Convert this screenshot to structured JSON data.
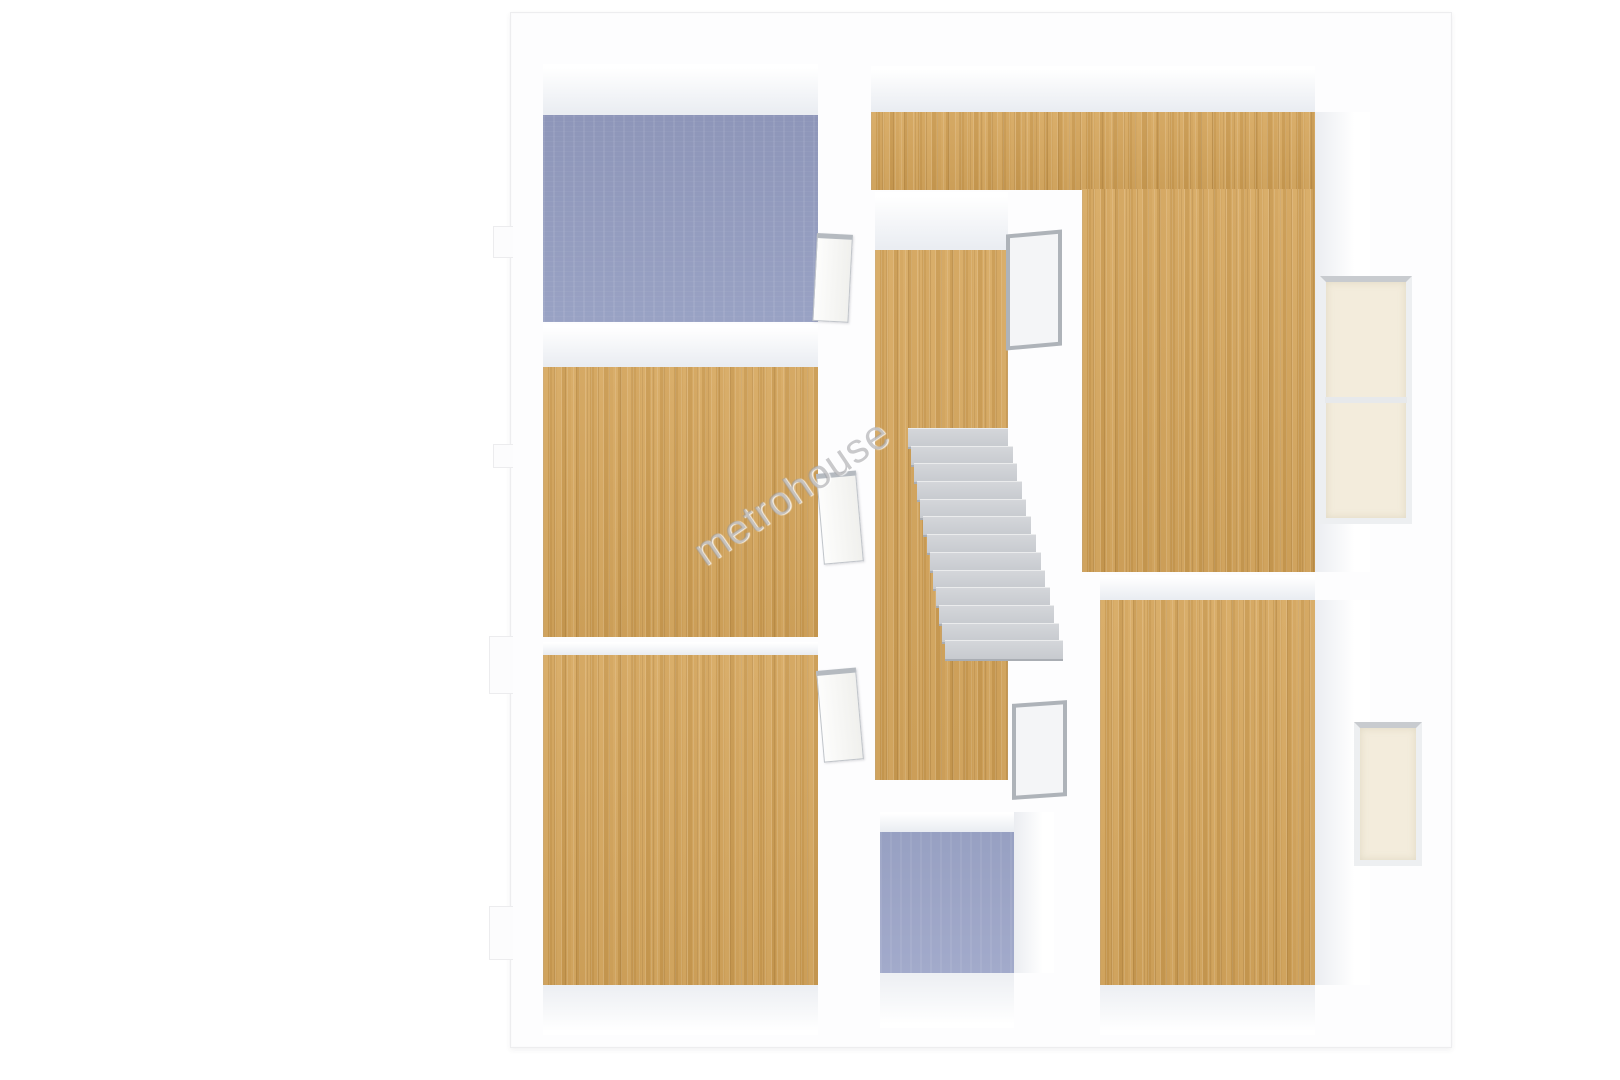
{
  "watermark": {
    "text": "metrohouse"
  },
  "palette": {
    "wall_white": "#fdfdfe",
    "wall_shade": "#eaedf2",
    "floor_wood": "#d1a259",
    "floor_wood_dark": "#ca9a50",
    "floor_carpet_blue": "#939cbf",
    "floor_carpet_blue_light": "#9aa3c6",
    "stair_gray": "#c9ccd1",
    "stair_shadow": "#a9adb3",
    "window_glass_cream": "#f3ecdc",
    "frame_gray": "#aeb3b9",
    "watermark_gray": "#98989c"
  },
  "plan": {
    "outer": {
      "name": "floorplan-outer-walls",
      "rect": [
        510,
        12,
        942,
        1036
      ]
    },
    "regions": [
      {
        "name": "wall-face-room-top-left",
        "kind": "face-down",
        "rect": [
          543,
          64,
          275,
          51
        ]
      },
      {
        "name": "wall-face-hallway-top",
        "kind": "face-down",
        "rect": [
          871,
          66,
          444,
          46
        ]
      },
      {
        "name": "wall-face-room-mid-left",
        "kind": "face-down",
        "rect": [
          543,
          324,
          275,
          43
        ]
      },
      {
        "name": "wall-face-room-bottom-left",
        "kind": "face-down",
        "rect": [
          543,
          642,
          275,
          13
        ]
      },
      {
        "name": "wall-face-stairwell-top",
        "kind": "face-down",
        "rect": [
          875,
          192,
          133,
          58
        ]
      },
      {
        "name": "wall-face-room-right-lower-top",
        "kind": "face-down",
        "rect": [
          1100,
          575,
          215,
          25
        ]
      },
      {
        "name": "wall-face-bathroom-top",
        "kind": "face-down",
        "rect": [
          880,
          812,
          134,
          20
        ]
      },
      {
        "name": "wall-face-right-upper-side",
        "kind": "face-right",
        "rect": [
          1315,
          112,
          55,
          460
        ]
      },
      {
        "name": "wall-face-right-lower-side",
        "kind": "face-right",
        "rect": [
          1315,
          600,
          55,
          385
        ]
      },
      {
        "name": "wall-face-bathroom-side",
        "kind": "face-right",
        "rect": [
          1014,
          812,
          40,
          161
        ]
      },
      {
        "name": "wall-face-under-room-bottom-left",
        "kind": "face-up",
        "rect": [
          543,
          985,
          275,
          50
        ]
      },
      {
        "name": "wall-face-under-bathroom",
        "kind": "face-up",
        "rect": [
          880,
          973,
          134,
          55
        ]
      },
      {
        "name": "wall-face-under-room-right-lower",
        "kind": "face-up",
        "rect": [
          1100,
          985,
          215,
          50
        ]
      },
      {
        "name": "floor-room-top-left",
        "kind": "floor-blue",
        "rect": [
          543,
          115,
          275,
          207
        ]
      },
      {
        "name": "floor-room-mid-left",
        "kind": "floor-wood",
        "rect": [
          543,
          367,
          275,
          270
        ]
      },
      {
        "name": "floor-room-bottom-left",
        "kind": "floor-wood",
        "rect": [
          543,
          655,
          275,
          330
        ]
      },
      {
        "name": "floor-hallway-top",
        "kind": "floor-wood",
        "rect": [
          871,
          112,
          444,
          78
        ]
      },
      {
        "name": "floor-room-right-upper",
        "kind": "floor-wood",
        "rect": [
          1082,
          189,
          233,
          383
        ]
      },
      {
        "name": "floor-stairwell",
        "kind": "floor-wood",
        "rect": [
          875,
          250,
          133,
          530
        ]
      },
      {
        "name": "floor-room-right-lower",
        "kind": "floor-wood",
        "rect": [
          1100,
          600,
          215,
          385
        ]
      },
      {
        "name": "floor-bathroom",
        "kind": "floor-blue-light",
        "rect": [
          880,
          832,
          134,
          141
        ]
      }
    ],
    "stairs": {
      "name": "staircase",
      "steps": 13,
      "y_top": 428,
      "y_bottom": 658,
      "x_top": 908,
      "w_top": 100,
      "x_bottom": 945,
      "w_bottom": 118
    },
    "windows": [
      {
        "name": "window-right-upper",
        "rect": [
          1320,
          276,
          92,
          248
        ],
        "panes": 2
      },
      {
        "name": "window-right-lower",
        "rect": [
          1354,
          722,
          68,
          144
        ],
        "panes": 1
      }
    ],
    "openings": [
      {
        "name": "stairwell-opening-upper",
        "rect": [
          1006,
          232,
          56,
          116
        ],
        "skew": -5
      },
      {
        "name": "stairwell-opening-lower",
        "rect": [
          1012,
          702,
          55,
          96
        ],
        "skew": -4
      }
    ],
    "doors": [
      {
        "name": "door-room-top-left",
        "rect": [
          817,
          233,
          36,
          88
        ],
        "angle": 3
      },
      {
        "name": "door-room-mid-left",
        "rect": [
          816,
          474,
          40,
          91
        ],
        "angle": -5
      },
      {
        "name": "door-room-bottom-left",
        "rect": [
          816,
          671,
          40,
          92
        ],
        "angle": -5
      }
    ],
    "bumps": [
      {
        "name": "left-wall-pilaster-1",
        "rect": [
          493,
          226,
          20,
          32
        ]
      },
      {
        "name": "left-wall-pilaster-2",
        "rect": [
          493,
          444,
          20,
          24
        ]
      },
      {
        "name": "left-wall-pilaster-3",
        "rect": [
          489,
          636,
          24,
          58
        ]
      },
      {
        "name": "left-wall-pilaster-4",
        "rect": [
          489,
          906,
          24,
          54
        ]
      }
    ]
  }
}
